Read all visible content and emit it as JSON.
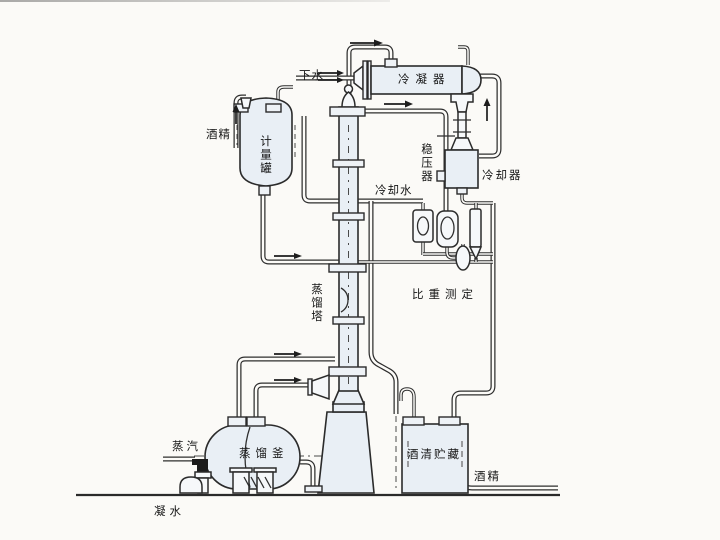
{
  "diagram": {
    "kind": "alcohol-distillation-process-flow-diagram",
    "labels": {
      "drain_water": "下水",
      "condenser": "冷凝器",
      "alcohol_feed": "酒精",
      "metering_tank": "计量罐",
      "pressure_stabilizer": "稳压器",
      "cooler": "冷却器",
      "cooling_water": "冷却水",
      "specific_gravity_measurement": "比重测定",
      "distillation_column": "蒸馏塔",
      "steam": "蒸汽",
      "distillation_still": "蒸馏釜",
      "alcohol_storage": "酒清贮藏",
      "alcohol_out": "酒精",
      "condensate": "凝水"
    },
    "colors": {
      "line": "#2e2e2e",
      "vessel_fill": "#e9eff5",
      "background": "#fbfaf7"
    }
  }
}
